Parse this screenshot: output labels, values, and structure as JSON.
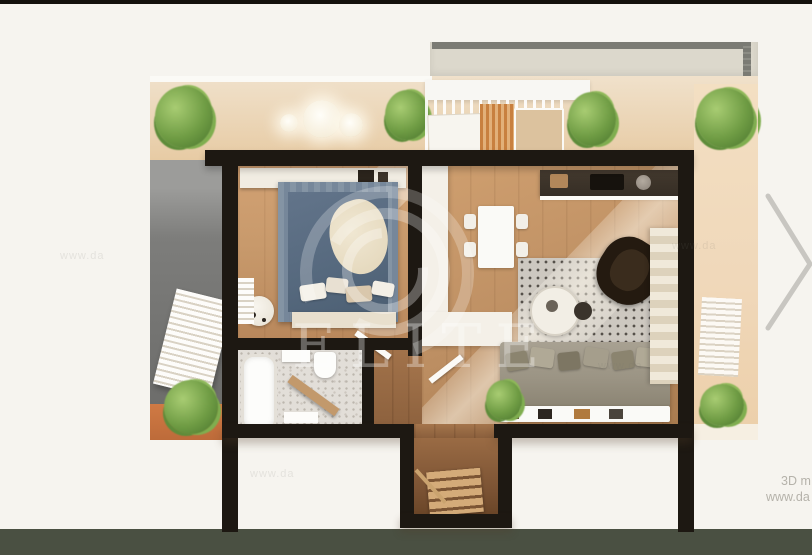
{
  "page": {
    "watermark_brand": "ELITE",
    "footer_line1": "3D m",
    "footer_line2": "www.da"
  },
  "icons": {
    "next": "chevron-right"
  },
  "colors": {
    "bg": "#f6f4ef",
    "topbar": "#14110c",
    "band": "#4a5042",
    "wall": "#1d1812",
    "wood1": "#c89a6c",
    "wood2": "#bd8f63",
    "wood3": "#8a5f3c",
    "terrace": "#ecd5b4",
    "terrace2": "#f0d8ba",
    "upper": "#dcd8cc",
    "rail": "#7b7b74",
    "facade": "#747472",
    "bluerug": "#56697e",
    "bluerugedge": "#8494a4",
    "rug": "#cdc8c0",
    "sofa": "#9b9484",
    "armchair": "#241a10",
    "bath": "#e2ded8",
    "plant": "#6f9c44",
    "planter": "#bd6b3a",
    "chevron": "#c8c6c1",
    "footer": "#b5b2aa",
    "wm": "rgba(255,255,255,0.33)"
  }
}
